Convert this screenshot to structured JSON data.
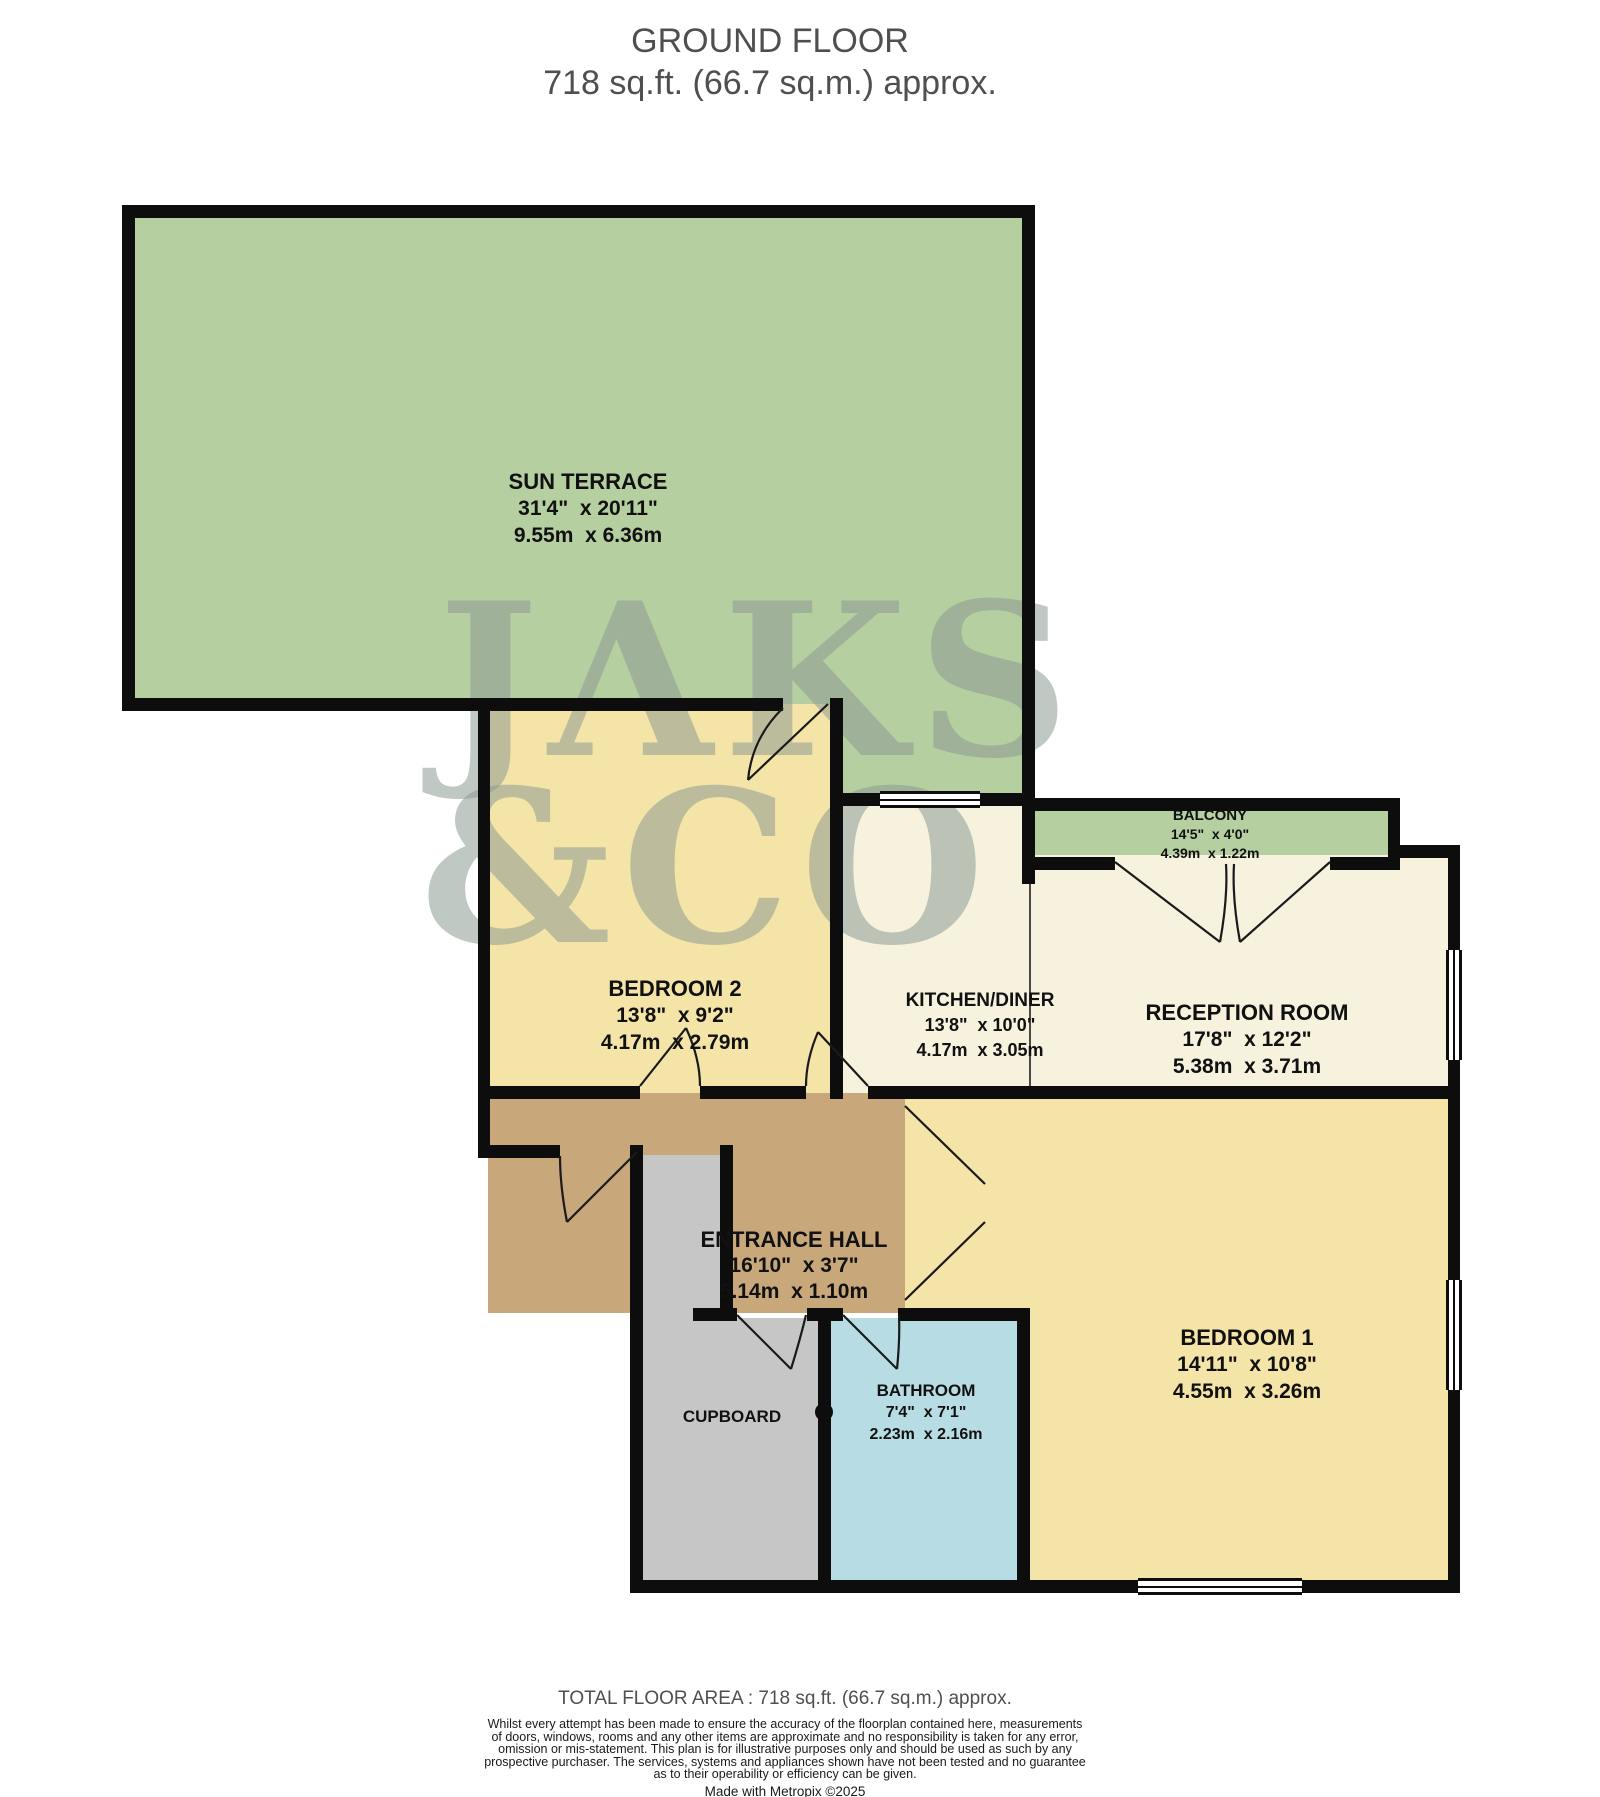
{
  "title": {
    "line1": "GROUND FLOOR",
    "line2": "718 sq.ft. (66.7 sq.m.) approx."
  },
  "watermark": {
    "line1": "JAKS",
    "line2": "&CO"
  },
  "rooms": {
    "sun_terrace": {
      "name": "SUN TERRACE",
      "size_ft": "31'4\"  x 20'11\"",
      "size_m": "9.55m  x 6.36m"
    },
    "bedroom2": {
      "name": "BEDROOM 2",
      "size_ft": "13'8\"  x 9'2\"",
      "size_m": "4.17m  x 2.79m"
    },
    "kitchen": {
      "name": "KITCHEN/DINER",
      "size_ft": "13'8\"  x 10'0\"",
      "size_m": "4.17m  x 3.05m"
    },
    "balcony": {
      "name": "BALCONY",
      "size_ft": "14'5\"  x 4'0\"",
      "size_m": "4.39m  x 1.22m"
    },
    "reception": {
      "name": "RECEPTION ROOM",
      "size_ft": "17'8\"  x 12'2\"",
      "size_m": "5.38m  x 3.71m"
    },
    "hall": {
      "name": "ENTRANCE HALL",
      "size_ft": "16'10\"  x 3'7\"",
      "size_m": "5.14m  x 1.10m"
    },
    "bathroom": {
      "name": "BATHROOM",
      "size_ft": "7'4\"  x 7'1\"",
      "size_m": "2.23m  x 2.16m"
    },
    "cupboard": {
      "name": "CUPBOARD"
    },
    "bedroom1": {
      "name": "BEDROOM 1",
      "size_ft": "14'11\"  x 10'8\"",
      "size_m": "4.55m  x 3.26m"
    }
  },
  "footer": {
    "total_area": "TOTAL FLOOR AREA : 718 sq.ft. (66.7 sq.m.) approx.",
    "disclaimer_line1": "Whilst every attempt has been made to ensure the accuracy of the floorplan contained here, measurements",
    "disclaimer_line2": "of doors, windows, rooms and any other items are approximate and no responsibility is taken for any error,",
    "disclaimer_line3": "omission or mis-statement. This plan is for illustrative purposes only and should be used as such by any",
    "disclaimer_line4": "prospective purchaser. The services, systems and appliances shown have not been tested and no guarantee",
    "disclaimer_line5": "as to their operability or efficiency can be given.",
    "made_with": "Made with Metropix ©2025"
  },
  "colors": {
    "terrace": "#b5cfa1",
    "balcony": "#b5cfa1",
    "bedroom": "#f5e4a7",
    "living": "#f6f2de",
    "hall": "#c8a77b",
    "bathroom": "#b7dce4",
    "cupboard": "#c6c6c6",
    "wall": "#0d0d0d",
    "label": "#111111",
    "title_text": "#4f4f4f",
    "watermark": "#8e9c94"
  }
}
